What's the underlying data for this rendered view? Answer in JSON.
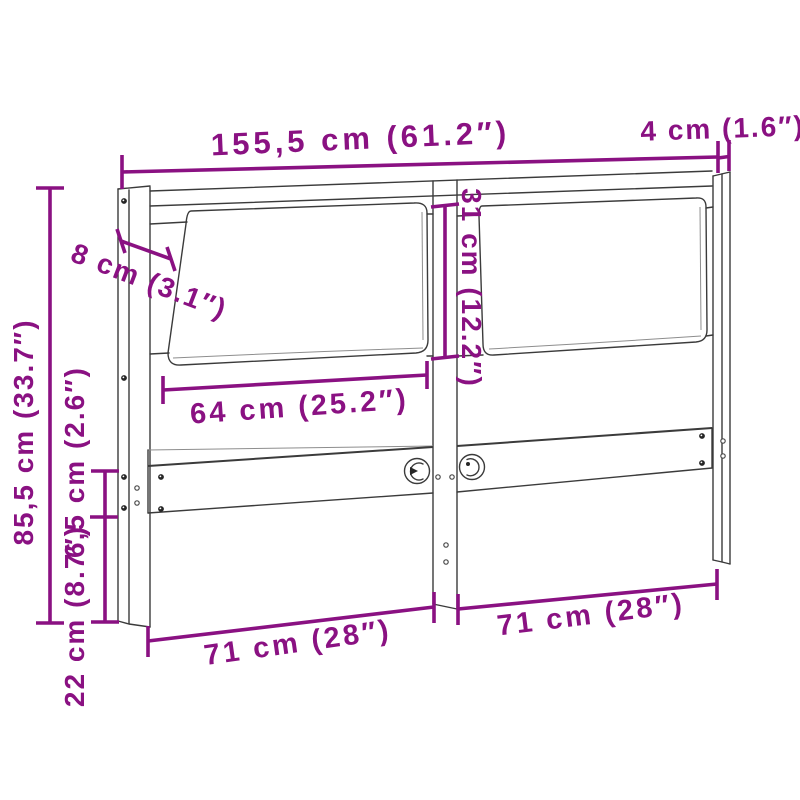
{
  "diagram": {
    "kind": "headboard dimension drawing",
    "colors": {
      "dimension_accent": "#8A1182",
      "line_work": "#3b3b3b",
      "background": "#ffffff"
    },
    "labels": {
      "total_width": "155,5 cm (61.2″)",
      "post_depth": "4 cm (1.6″)",
      "cushion_inset": "8 cm (3.1″)",
      "total_height": "85,5 cm (33.7″)",
      "rail_height": "6,5 cm (2.6″)",
      "lower_section": "22 cm (8.7″)",
      "cushion_width": "64 cm (25.2″)",
      "cushion_height": "31 cm (12.2″)",
      "left_section_width": "71 cm (28″)",
      "right_section_width": "71 cm (28″)"
    }
  }
}
